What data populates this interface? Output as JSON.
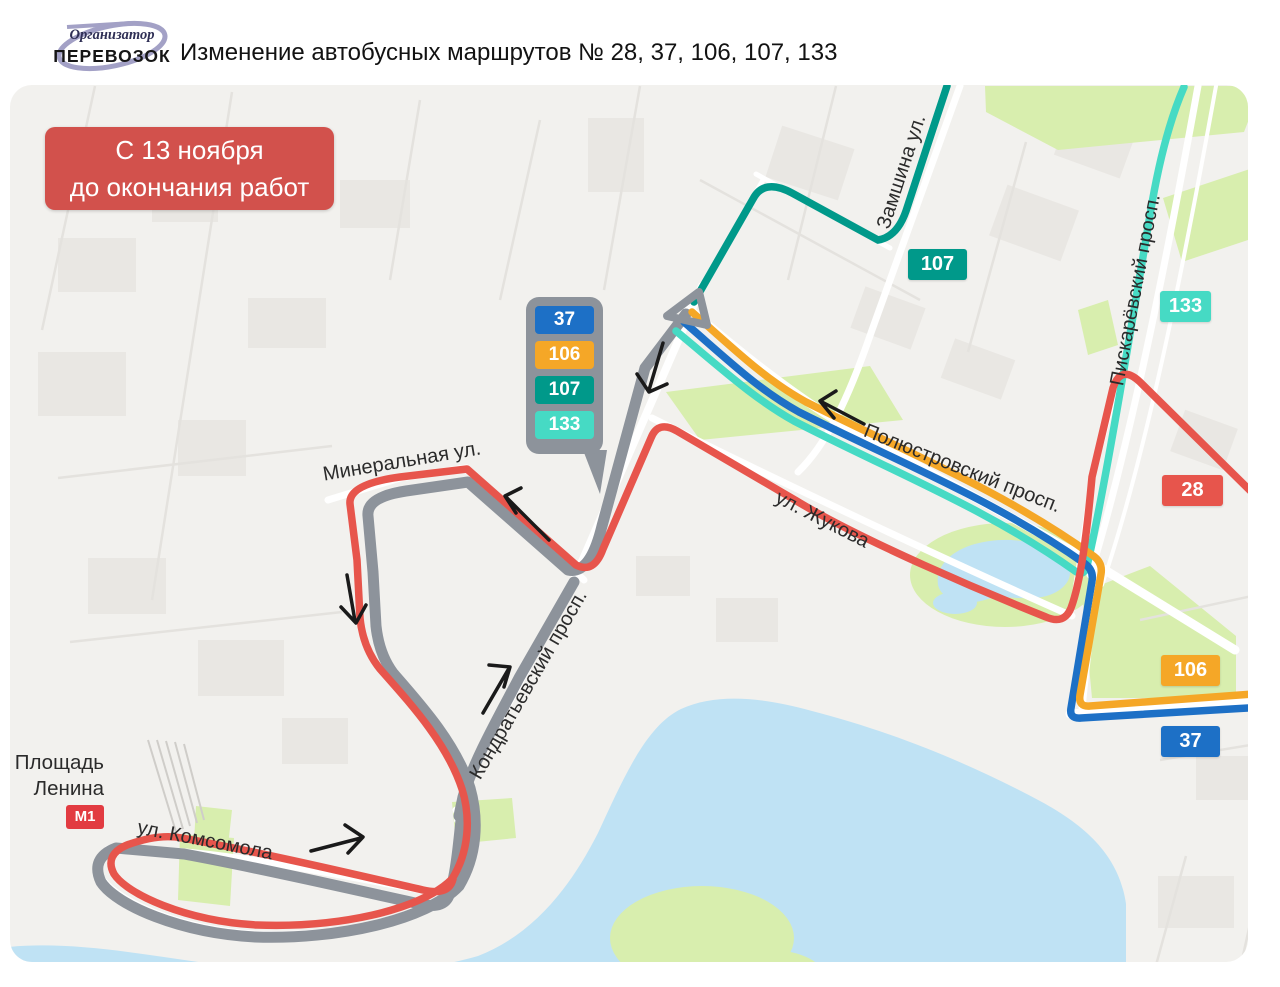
{
  "header": {
    "logo": {
      "line1": "Организатор",
      "line2": "ПЕРЕВОЗОК"
    },
    "title": "Изменение автобусных маршрутов  № 28, 37, 106, 107, 133"
  },
  "notice": {
    "line1": "С 13 ноября",
    "line2": "до окончания работ"
  },
  "callout": {
    "routes": [
      {
        "id": "37"
      },
      {
        "id": "106"
      },
      {
        "id": "107"
      },
      {
        "id": "133"
      }
    ]
  },
  "map": {
    "route_badges": [
      {
        "id": "107"
      },
      {
        "id": "133"
      },
      {
        "id": "28"
      },
      {
        "id": "106"
      },
      {
        "id": "37"
      }
    ],
    "streets": {
      "zamshina": "Замшина ул.",
      "piskarevsky": "Пискарёвский просп.",
      "polyustrovsky": "Полюстровский просп.",
      "zhukova": "ул. Жукова",
      "mineralnaya": "Минеральная ул.",
      "kondratievsky": "Кондратьевский просп.",
      "komsomola": "ул. Комсомола"
    },
    "place": {
      "line1": "Площадь",
      "line2": "Ленина",
      "metro": "М1"
    }
  },
  "colors": {
    "red": "#e7554c",
    "blue": "#1d70c6",
    "orange": "#f5a727",
    "teal": "#00998a",
    "cyan": "#46dac4",
    "gray_route": "#8d939b",
    "notice_bg": "#d2514c",
    "metro_red": "#e23b41",
    "map_bg": "#f2f1ee",
    "green": "#d8eeae",
    "water": "#bfe2f4",
    "building": "#e9e7e3",
    "road_minor": "#e4e2de",
    "road_white": "#ffffff",
    "arrow": "#1a1a1a",
    "label": "#2b2b2b",
    "logo_purple": "#a3a1c6"
  }
}
